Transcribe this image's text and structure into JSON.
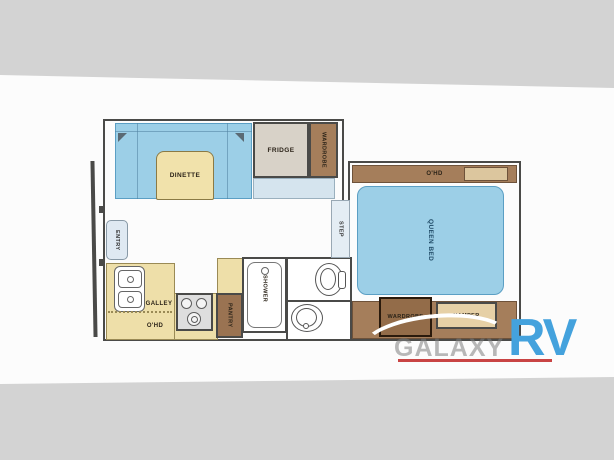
{
  "page": {
    "background": "#d3d3d3",
    "paper": "#fcfcfc"
  },
  "floorplan": {
    "labels": {
      "dinette": "DINETTE",
      "fridge": "FRIDGE",
      "wardrobe_top": "WARDROBE",
      "entry": "ENTRY",
      "galley": "GALLEY",
      "galley_overhead": "O'HD",
      "pantry": "PANTRY",
      "shower": "SHOWER",
      "step": "STEP",
      "bedroom_overhead": "O'HD",
      "queen_bed": "QUEEN BED",
      "wardrobe_bedroom": "WARDROBE",
      "hamper": "HAMPER"
    },
    "colors": {
      "wall": "#4a4a48",
      "furniture_blue": "#9ccfe7",
      "counter_tan": "#eedfa9",
      "cabinet_brown": "#a57e5b",
      "fridge_beige": "#d8d2c8",
      "soft_blue": "#dfe9f2"
    }
  },
  "watermark": {
    "brand": "GALAXY",
    "suffix": "RV",
    "brand_color_hex": "#7d7d7d",
    "suffix_color_hex": "#44a2dd",
    "underline_color_hex": "#c94444"
  }
}
